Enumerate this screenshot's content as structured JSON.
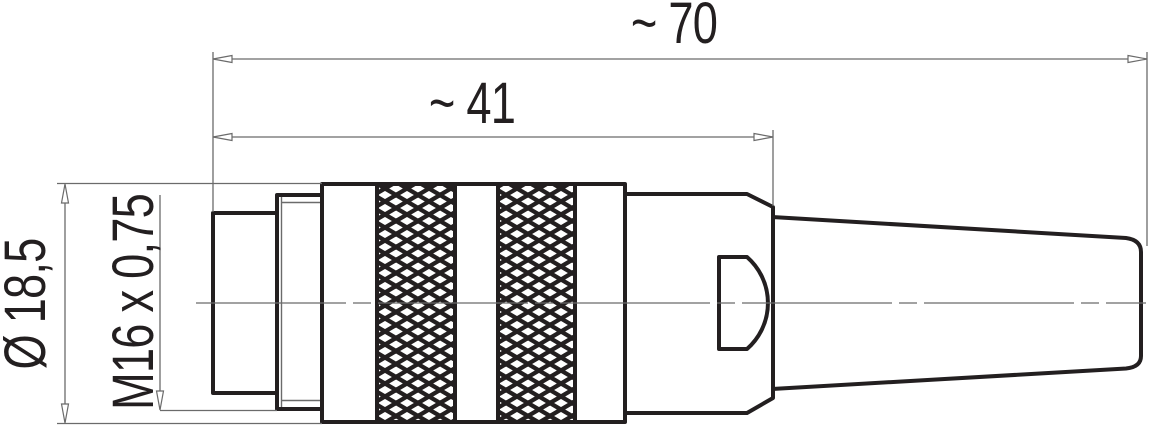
{
  "labels": {
    "total_length": "~ 70",
    "body_length": "~ 41",
    "diameter": "Ø 18,5",
    "thread": "M16 x 0,75"
  },
  "colors": {
    "outline": "#231f20",
    "dimension": "#6b6b6b",
    "background": "#ffffff"
  }
}
